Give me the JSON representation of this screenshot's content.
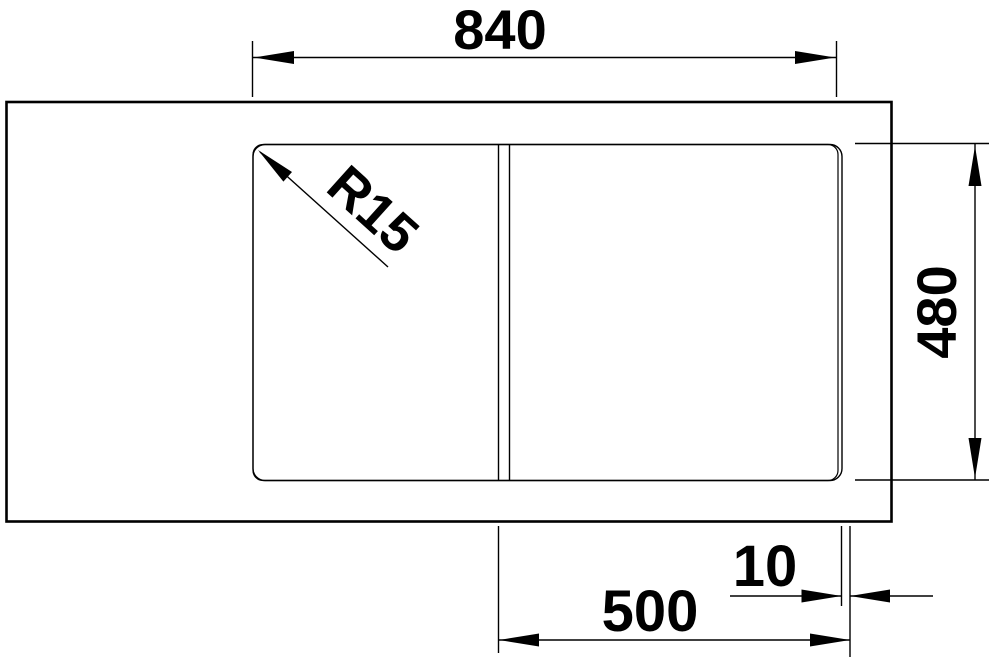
{
  "figure": {
    "kind": "sink-top-view-dimension-drawing",
    "colors": {
      "background": "#ffffff",
      "line": "#000000",
      "text": "#000000"
    },
    "annotations": {
      "overall_width": "840",
      "overall_depth": "480",
      "bowl_width": "500",
      "rim_offset": "10",
      "corner_radius": "R15"
    }
  }
}
